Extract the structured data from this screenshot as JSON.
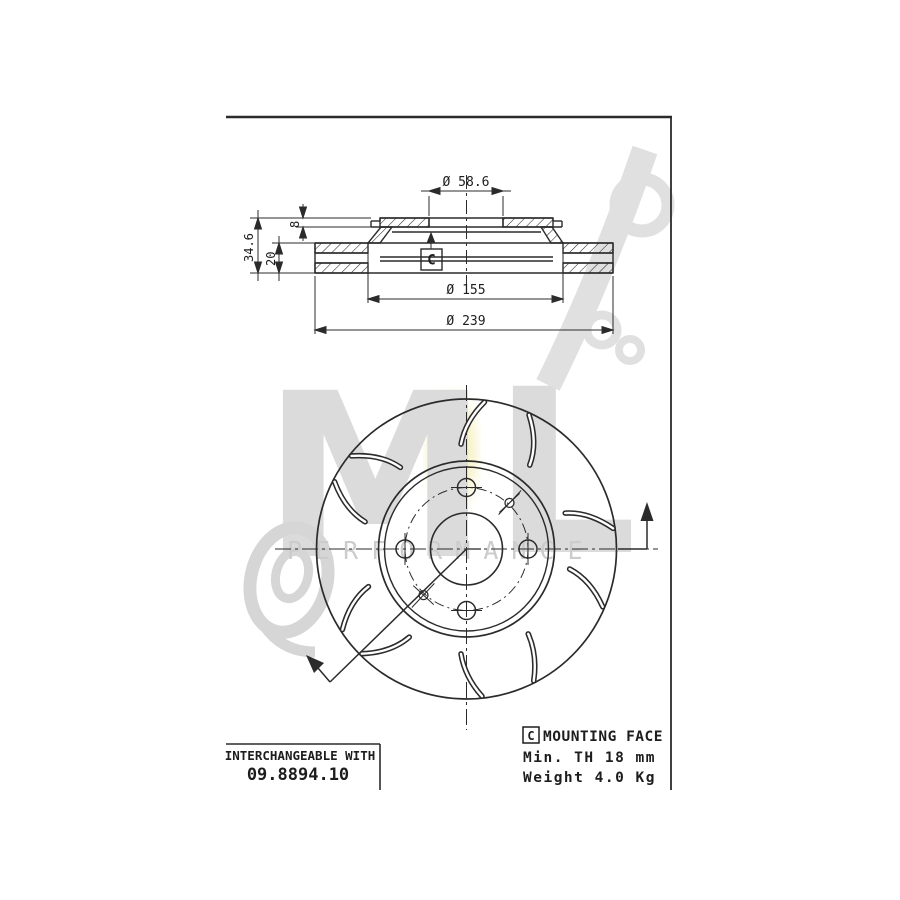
{
  "dimensions": {
    "bore_diameter": "Ø 58.6",
    "hat_diameter": "Ø 155",
    "outer_diameter": "Ø 239",
    "total_height": "34.6",
    "band_thickness": "20",
    "flange_thickness": "8"
  },
  "mounting_face_marker": "C",
  "notes": {
    "marker": "C",
    "mounting_face": "MOUNTING FACE",
    "min_thickness": "Min. TH 18 mm",
    "weight": "Weight 4.0 Kg"
  },
  "interchangeable_box": {
    "label": "INTERCHANGEABLE WITH",
    "part_number": "09.8894.10"
  },
  "watermark": {
    "letter_m": "M",
    "letter_l": "L",
    "slogan": "PERFORMANCE"
  },
  "colors": {
    "line": "#2b2b2b",
    "watermark": "#d9d9d9",
    "highlight": "#f3ecae"
  }
}
